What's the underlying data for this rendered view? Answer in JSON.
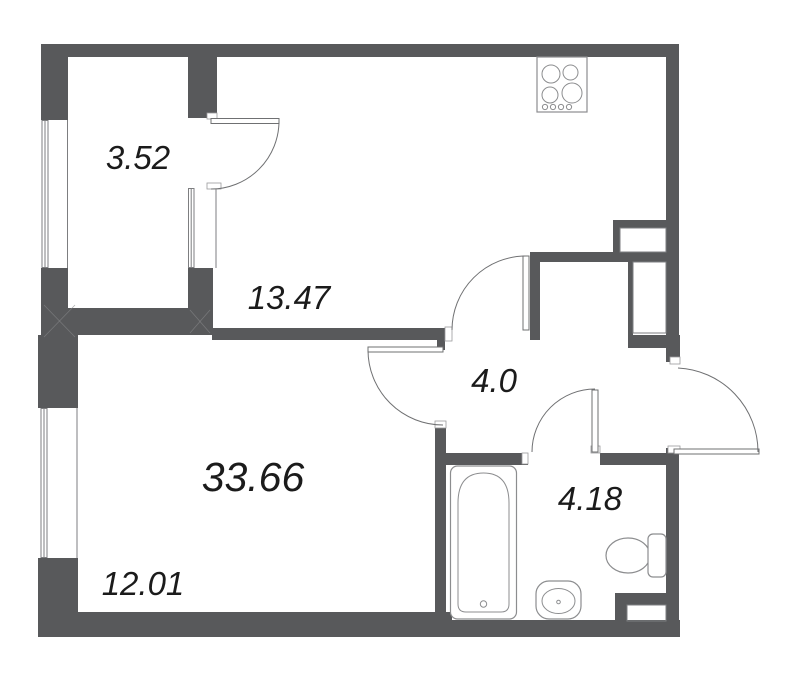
{
  "floorplan": {
    "type": "apartment-floor-plan",
    "background_color": "#ffffff",
    "wall_color": "#58595b",
    "line_color": "#6f7072",
    "label_color": "#1b1b1b",
    "rooms": [
      {
        "id": "balcony",
        "area": "3.52"
      },
      {
        "id": "kitchen",
        "area": "13.47"
      },
      {
        "id": "hallway",
        "area": "4.0"
      },
      {
        "id": "living-room-total",
        "area": "33.66"
      },
      {
        "id": "bathroom",
        "area": "4.18"
      },
      {
        "id": "living-room",
        "area": "12.01"
      }
    ],
    "fixtures": [
      "stove",
      "bathtub",
      "sink",
      "toilet"
    ],
    "door_count": 5,
    "window_count": 3
  }
}
